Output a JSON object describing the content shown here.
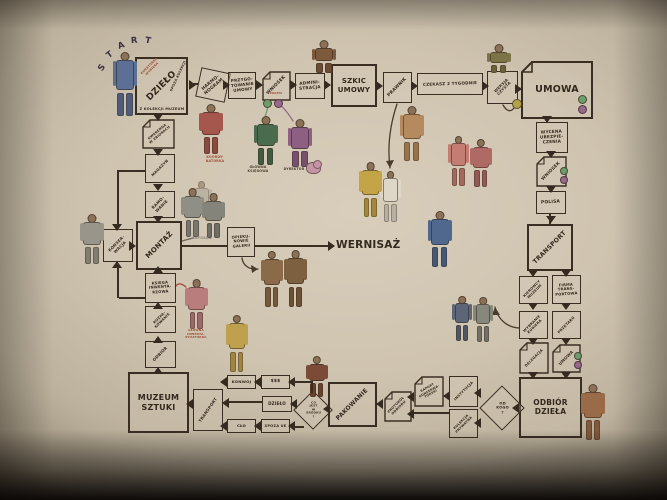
{
  "palette": {
    "wall": "#cfc4b0",
    "ink": "#3a2e22",
    "caption_red": "#9e4a38",
    "sig_green": "#6f9c6d",
    "sig_violet": "#96688c",
    "sig_yellow": "#b3a14b"
  },
  "diagram": {
    "start": {
      "text": "START"
    },
    "nodes": [
      {
        "id": "dzielo",
        "label": "DZIEŁO",
        "type": "box",
        "x": 135,
        "y": 57,
        "w": 53,
        "h": 58,
        "fs": 9,
        "rot": -45,
        "thick": true
      },
      {
        "id": "harmonogram",
        "label": "HARMO-\nNOGRAM",
        "type": "box",
        "x": 198,
        "y": 70,
        "w": 30,
        "h": 30,
        "fs": 4.4,
        "rot": -40,
        "tilt": 12
      },
      {
        "id": "przygotowanie-umowy",
        "label": "PRZYGO-\nTOWANIE\nUMOWY",
        "type": "box",
        "x": 228,
        "y": 72,
        "w": 28,
        "h": 27,
        "fs": 4.1,
        "rot": -6
      },
      {
        "id": "wniosek-1",
        "label": "WNIOSEK",
        "type": "doc",
        "x": 262,
        "y": 71,
        "w": 29,
        "h": 30,
        "fs": 4.4,
        "rot": -45
      },
      {
        "id": "administracja",
        "label": "ADMINI-\nSTRACJA",
        "type": "box",
        "x": 295,
        "y": 73,
        "w": 30,
        "h": 26,
        "fs": 4.2,
        "rot": -5
      },
      {
        "id": "szkic-umowy",
        "label": "SZKIC\nUMOWY",
        "type": "box",
        "x": 331,
        "y": 64,
        "w": 46,
        "h": 43,
        "fs": 7,
        "rot": 0,
        "thick": true
      },
      {
        "id": "prawnik",
        "label": "PRAWNIK",
        "type": "box",
        "x": 383,
        "y": 72,
        "w": 29,
        "h": 31,
        "fs": 4.4,
        "rot": -45
      },
      {
        "id": "czekasz-2-tygodnie",
        "label": "CZEKASZ 2 TYGODNIE",
        "type": "box",
        "x": 417,
        "y": 73,
        "w": 66,
        "h": 22,
        "fs": 4.1,
        "rot": -2
      },
      {
        "id": "wersja-czysta",
        "label": "WERSJA\nCZYSTA",
        "type": "box",
        "x": 487,
        "y": 71,
        "w": 31,
        "h": 33,
        "fs": 3.8,
        "rot": -45
      },
      {
        "id": "umowa",
        "label": "UMOWA",
        "type": "doc",
        "x": 521,
        "y": 61,
        "w": 72,
        "h": 58,
        "fs": 9.5,
        "rot": 0,
        "thick": true,
        "fold": 11
      },
      {
        "id": "wycena-ubezpieczenia",
        "label": "WYCENA\nUBEZPIE-\nCZENIA",
        "type": "box",
        "x": 536,
        "y": 122,
        "w": 32,
        "h": 31,
        "fs": 4.2,
        "rot": -3
      },
      {
        "id": "wniosek-2",
        "label": "WNIOSEK",
        "type": "doc",
        "x": 536,
        "y": 156,
        "w": 31,
        "h": 31,
        "fs": 4.3,
        "rot": -45
      },
      {
        "id": "polisa",
        "label": "POLISA",
        "type": "box",
        "x": 536,
        "y": 191,
        "w": 30,
        "h": 23,
        "fs": 4.4,
        "rot": -3
      },
      {
        "id": "transport-1",
        "label": "TRANSPORT",
        "type": "box",
        "x": 527,
        "y": 224,
        "w": 46,
        "h": 47,
        "fs": 6.2,
        "rot": -45,
        "thick": true
      },
      {
        "id": "kierowcy-muzeum",
        "label": "KIEROWCY\nMUZEUM",
        "type": "box",
        "x": 519,
        "y": 276,
        "w": 29,
        "h": 28,
        "fs": 3.5,
        "rot": -45
      },
      {
        "id": "firma-transportowa",
        "label": "FIRMA\nTRANS-\nPORTOWA",
        "type": "box",
        "x": 552,
        "y": 275,
        "w": 29,
        "h": 29,
        "fs": 3.7,
        "rot": -4
      },
      {
        "id": "wybranie-kuriera",
        "label": "WYBRANIE\nKURIERA",
        "type": "box",
        "x": 519,
        "y": 311,
        "w": 29,
        "h": 28,
        "fs": 3.5,
        "rot": -45
      },
      {
        "id": "przetarg",
        "label": "PRZETARG",
        "type": "box",
        "x": 552,
        "y": 311,
        "w": 29,
        "h": 28,
        "fs": 3.6,
        "rot": -45
      },
      {
        "id": "delegacja",
        "label": "DELEGACJA",
        "type": "doc",
        "x": 519,
        "y": 342,
        "w": 30,
        "h": 32,
        "fs": 3.5,
        "rot": -45
      },
      {
        "id": "umowa-2",
        "label": "UMOWA",
        "type": "doc",
        "x": 552,
        "y": 344,
        "w": 29,
        "h": 29,
        "fs": 4,
        "rot": -45
      },
      {
        "id": "odbior-dziela",
        "label": "ODBIÓR\nDZIEŁA",
        "type": "box",
        "x": 519,
        "y": 377,
        "w": 63,
        "h": 61,
        "fs": 7.5,
        "rot": 0,
        "thick": true
      },
      {
        "id": "od-kogo",
        "label": "OD\nKOGO\n?",
        "type": "diamond",
        "x": 486,
        "y": 392,
        "w": 32,
        "h": 32,
        "fs": 3.7,
        "rot": 0
      },
      {
        "id": "instytucja",
        "label": "INSTYTUCJA",
        "type": "box",
        "x": 449,
        "y": 376,
        "w": 29,
        "h": 31,
        "fs": 3.5,
        "rot": -45
      },
      {
        "id": "kolekcja-prywatna",
        "label": "KOLEKCJA\nPRYWATNA",
        "type": "box",
        "x": 449,
        "y": 409,
        "w": 29,
        "h": 29,
        "fs": 3.3,
        "rot": -45
      },
      {
        "id": "raport-konserwatorski",
        "label": "RAPORT\nKONSERWA-\nTORSKI",
        "type": "doc",
        "x": 414,
        "y": 376,
        "w": 30,
        "h": 31,
        "fs": 3.1,
        "rot": -30
      },
      {
        "id": "protokol-odbioru",
        "label": "PROTOKÓŁ\nODBIORU",
        "type": "doc",
        "x": 384,
        "y": 391,
        "w": 28,
        "h": 31,
        "fs": 3.3,
        "rot": -45
      },
      {
        "id": "pakowanie",
        "label": "PAKOWANIE",
        "type": "box",
        "x": 328,
        "y": 382,
        "w": 49,
        "h": 45,
        "fs": 6,
        "rot": -45,
        "thick": true
      },
      {
        "id": "co-jest-w-srodku",
        "label": "CO\nJEST\nW\nŚRODKU\n?",
        "type": "diamond",
        "x": 299,
        "y": 396,
        "w": 28,
        "h": 28,
        "fs": 2.9,
        "rot": 0
      },
      {
        "id": "konwoj",
        "label": "KONWÓJ",
        "type": "box",
        "x": 227,
        "y": 375,
        "w": 29,
        "h": 14,
        "fs": 3.9,
        "rot": 0
      },
      {
        "id": "dolary",
        "label": "$$$",
        "type": "box",
        "x": 261,
        "y": 375,
        "w": 29,
        "h": 14,
        "fs": 4.4,
        "rot": 0
      },
      {
        "id": "dzielo-2",
        "label": "DZIEŁO",
        "type": "box",
        "x": 262,
        "y": 396,
        "w": 30,
        "h": 16,
        "fs": 4.1,
        "rot": 0
      },
      {
        "id": "clo",
        "label": "CŁO",
        "type": "box",
        "x": 227,
        "y": 419,
        "w": 29,
        "h": 14,
        "fs": 3.9,
        "rot": 0
      },
      {
        "id": "spoza-ue",
        "label": "SPOZA UE",
        "type": "box",
        "x": 261,
        "y": 419,
        "w": 29,
        "h": 14,
        "fs": 3.6,
        "rot": 0
      },
      {
        "id": "transport-2",
        "label": "TRANSPORT",
        "type": "box",
        "x": 193,
        "y": 389,
        "w": 30,
        "h": 42,
        "fs": 4,
        "rot": -55
      },
      {
        "id": "muzeum-sztuki",
        "label": "MUZEUM\nSZTUKI",
        "type": "box",
        "x": 128,
        "y": 372,
        "w": 61,
        "h": 61,
        "fs": 8,
        "rot": 0,
        "thick": true
      },
      {
        "id": "odbior",
        "label": "ODBIÓR",
        "type": "box",
        "x": 145,
        "y": 341,
        "w": 31,
        "h": 27,
        "fs": 4,
        "rot": -45
      },
      {
        "id": "rozpakowanie",
        "label": "ROZPA-\nKOWANIE",
        "type": "box",
        "x": 145,
        "y": 306,
        "w": 31,
        "h": 27,
        "fs": 3.5,
        "rot": -45
      },
      {
        "id": "ksiega-inwentarzowa",
        "label": "KSIĘGA\nINWENTA-\nRZOWA",
        "type": "box",
        "x": 145,
        "y": 273,
        "w": 31,
        "h": 30,
        "fs": 3.7,
        "rot": -4
      },
      {
        "id": "montaz",
        "label": "MONTAŻ",
        "type": "box",
        "x": 136,
        "y": 221,
        "w": 46,
        "h": 49,
        "fs": 7,
        "rot": -45,
        "thick": true
      },
      {
        "id": "ramowanie",
        "label": "RAMO-\nWANIE",
        "type": "box",
        "x": 145,
        "y": 191,
        "w": 30,
        "h": 27,
        "fs": 4,
        "rot": -45
      },
      {
        "id": "magazyn",
        "label": "MAGAZYN",
        "type": "box",
        "x": 145,
        "y": 154,
        "w": 30,
        "h": 29,
        "fs": 3.7,
        "rot": -45
      },
      {
        "id": "kwerenda-w-zbiorach",
        "label": "KWERENDA\nW ZBIORACH",
        "type": "doc",
        "x": 142,
        "y": 119,
        "w": 33,
        "h": 30,
        "fs": 3.3,
        "rot": -40
      },
      {
        "id": "konserwacja",
        "label": "KONSER-\nWACJA",
        "type": "box",
        "x": 103,
        "y": 229,
        "w": 30,
        "h": 33,
        "fs": 3.9,
        "rot": -45
      },
      {
        "id": "opiekunowie-galerii",
        "label": "OPIEKU-\nNOWIE\nGALERII",
        "type": "box",
        "x": 227,
        "y": 227,
        "w": 28,
        "h": 30,
        "fs": 3.7,
        "rot": -4
      }
    ],
    "captions": [
      {
        "id": "wernisaz",
        "text": "WERNISAŻ",
        "x": 336,
        "y": 239,
        "w": 62,
        "fs": 10.5,
        "color": "#352a1f"
      },
      {
        "id": "kuratorka-wybiera",
        "text": "KURATORKA\nWYBIERA",
        "x": 138,
        "y": 64,
        "w": 26,
        "fs": 3,
        "color": "#9e4a38",
        "rot": -45
      },
      {
        "id": "spoza-kolekcji",
        "text": "SPOZA KOLEKCJI",
        "x": 160,
        "y": 74,
        "w": 36,
        "fs": 3.3,
        "color": "#3a2e22",
        "rot": -65
      },
      {
        "id": "z-kolekcji-muzeum",
        "text": "Z KOLEKCJI MUZEUM",
        "x": 135,
        "y": 107,
        "w": 54,
        "fs": 3.6,
        "color": "#3a2e22"
      },
      {
        "id": "podpis",
        "text": "PODPIS",
        "x": 266,
        "y": 92,
        "w": 20,
        "fs": 2.7,
        "color": "#9e4a38"
      },
      {
        "id": "koordynatorka",
        "text": "KOORDY-\nNATORKA",
        "x": 201,
        "y": 155,
        "w": 28,
        "fs": 3.2,
        "color": "#9e4a38"
      },
      {
        "id": "glowna-ksiegowa",
        "text": "GŁÓWNA\nKSIĘGOWA",
        "x": 243,
        "y": 165,
        "w": 30,
        "fs": 3.2,
        "color": "#4a3a2c"
      },
      {
        "id": "dyrektor",
        "text": "DYREKTOR",
        "x": 279,
        "y": 167,
        "w": 30,
        "fs": 3.2,
        "color": "#4a3a2c"
      },
      {
        "id": "brygada",
        "text": "BRYGADA",
        "x": 188,
        "y": 236,
        "w": 28,
        "fs": 3.3,
        "color": "#8d887c"
      },
      {
        "id": "glowna-inwentaryzatorka",
        "text": "GŁÓWNA\nINWENTA-\nRYZATORKA",
        "x": 181,
        "y": 329,
        "w": 30,
        "fs": 2.9,
        "color": "#9e4a38"
      }
    ],
    "figures": [
      {
        "name": "kuratorka-start",
        "x": 112,
        "y": 52,
        "w": 26,
        "h": 64,
        "c": "#5c6f94"
      },
      {
        "name": "koordynatorka",
        "x": 199,
        "y": 104,
        "w": 24,
        "h": 50,
        "c": "#a5574d"
      },
      {
        "name": "glowna-ksiegowa",
        "x": 253,
        "y": 116,
        "w": 25,
        "h": 49,
        "c": "#4b6b4e"
      },
      {
        "name": "dyrektor",
        "x": 287,
        "y": 119,
        "w": 26,
        "h": 48,
        "c": "#8d5f83"
      },
      {
        "name": "administracja-sitter",
        "x": 311,
        "y": 40,
        "w": 26,
        "h": 33,
        "c": "#7d5a3c"
      },
      {
        "name": "wersja-czysta-climber",
        "x": 486,
        "y": 44,
        "w": 25,
        "h": 29,
        "c": "#7c7446"
      },
      {
        "name": "prawnik-walker",
        "x": 399,
        "y": 106,
        "w": 25,
        "h": 55,
        "c": "#b58a5e"
      },
      {
        "name": "white-figure",
        "x": 380,
        "y": 171,
        "w": 21,
        "h": 51,
        "c": "#ded7c8"
      },
      {
        "name": "pink-pair-a",
        "x": 448,
        "y": 136,
        "w": 21,
        "h": 50,
        "c": "#c47d72"
      },
      {
        "name": "pink-pair-b",
        "x": 470,
        "y": 139,
        "w": 22,
        "h": 48,
        "c": "#b06a66"
      },
      {
        "name": "yellow-visitor",
        "x": 359,
        "y": 162,
        "w": 23,
        "h": 55,
        "c": "#c3a446"
      },
      {
        "name": "blue-walker",
        "x": 427,
        "y": 211,
        "w": 25,
        "h": 56,
        "c": "#50688e"
      },
      {
        "name": "brygada-ghost",
        "x": 191,
        "y": 181,
        "w": 21,
        "h": 36,
        "c": "#a8a396",
        "o": 0.55
      },
      {
        "name": "brygada-a",
        "x": 181,
        "y": 188,
        "w": 23,
        "h": 49,
        "c": "#8f8f85"
      },
      {
        "name": "brygada-b",
        "x": 202,
        "y": 193,
        "w": 23,
        "h": 45,
        "c": "#84847a"
      },
      {
        "name": "konserwatorka",
        "x": 80,
        "y": 214,
        "w": 24,
        "h": 50,
        "c": "#9a958a"
      },
      {
        "name": "inwentaryzatorka",
        "x": 185,
        "y": 279,
        "w": 23,
        "h": 50,
        "c": "#b97d7d"
      },
      {
        "name": "opiekun-a",
        "x": 261,
        "y": 251,
        "w": 22,
        "h": 56,
        "c": "#8a6a48"
      },
      {
        "name": "opiekun-b",
        "x": 284,
        "y": 250,
        "w": 23,
        "h": 57,
        "c": "#7d603f"
      },
      {
        "name": "konwoj-stander",
        "x": 226,
        "y": 315,
        "w": 22,
        "h": 57,
        "c": "#bfa04e"
      },
      {
        "name": "diamond-stander",
        "x": 306,
        "y": 356,
        "w": 22,
        "h": 41,
        "c": "#7c4b38"
      },
      {
        "name": "kurier-a",
        "x": 452,
        "y": 296,
        "w": 20,
        "h": 45,
        "c": "#5d6678"
      },
      {
        "name": "kurier-b",
        "x": 473,
        "y": 297,
        "w": 20,
        "h": 45,
        "c": "#87887c"
      },
      {
        "name": "odbior-helper",
        "x": 581,
        "y": 384,
        "w": 24,
        "h": 56,
        "c": "#9a6b48"
      },
      {
        "name": "teddy-bear",
        "x": 306,
        "y": 160,
        "w": 16,
        "h": 14,
        "c": "#c495a5",
        "teddy": true
      }
    ],
    "dots": [
      {
        "x": 263,
        "y": 99,
        "r": 9,
        "c": "green"
      },
      {
        "x": 274,
        "y": 99,
        "r": 9,
        "c": "violet"
      },
      {
        "x": 578,
        "y": 95,
        "r": 9,
        "c": "green"
      },
      {
        "x": 578,
        "y": 105,
        "r": 9,
        "c": "violet"
      },
      {
        "x": 560,
        "y": 167,
        "r": 8,
        "c": "green"
      },
      {
        "x": 560,
        "y": 176,
        "r": 8,
        "c": "violet"
      },
      {
        "x": 574,
        "y": 352,
        "r": 8,
        "c": "green"
      },
      {
        "x": 574,
        "y": 361,
        "r": 8,
        "c": "violet"
      },
      {
        "x": 512,
        "y": 99,
        "r": 10,
        "c": "yellow"
      }
    ],
    "heads": [
      [
        189,
        80,
        "r"
      ],
      [
        223,
        80,
        "r"
      ],
      [
        256,
        80,
        "r"
      ],
      [
        290,
        80,
        "r"
      ],
      [
        324,
        80,
        "r"
      ],
      [
        376,
        81,
        "r"
      ],
      [
        411,
        81,
        "r"
      ],
      [
        482,
        81,
        "r"
      ],
      [
        515,
        84,
        "r"
      ],
      [
        542,
        116,
        "d"
      ],
      [
        546,
        151,
        "d"
      ],
      [
        546,
        186,
        "d"
      ],
      [
        546,
        216,
        "d"
      ],
      [
        528,
        270,
        "d"
      ],
      [
        561,
        270,
        "d"
      ],
      [
        528,
        303,
        "d"
      ],
      [
        561,
        303,
        "d"
      ],
      [
        528,
        338,
        "d"
      ],
      [
        561,
        338,
        "d"
      ],
      [
        528,
        372,
        "d"
      ],
      [
        561,
        372,
        "d"
      ],
      [
        153,
        114,
        "d"
      ],
      [
        153,
        149,
        "d"
      ],
      [
        153,
        184,
        "d"
      ],
      [
        153,
        216,
        "d"
      ],
      [
        153,
        266,
        "u"
      ],
      [
        153,
        302,
        "u"
      ],
      [
        153,
        336,
        "u"
      ],
      [
        153,
        367,
        "u"
      ],
      [
        112,
        224,
        "d"
      ],
      [
        112,
        261,
        "u"
      ],
      [
        129,
        241,
        "r"
      ],
      [
        328,
        241,
        "r"
      ],
      [
        512,
        403,
        "l"
      ],
      [
        474,
        388,
        "l"
      ],
      [
        474,
        418,
        "l"
      ],
      [
        443,
        391,
        "l"
      ],
      [
        407,
        392,
        "l"
      ],
      [
        407,
        409,
        "l"
      ],
      [
        376,
        399,
        "l"
      ],
      [
        323,
        404,
        "l"
      ],
      [
        288,
        377,
        "l"
      ],
      [
        254,
        377,
        "l"
      ],
      [
        220,
        377,
        "l"
      ],
      [
        290,
        399,
        "l"
      ],
      [
        222,
        398,
        "l"
      ],
      [
        288,
        421,
        "l"
      ],
      [
        254,
        421,
        "l"
      ],
      [
        220,
        421,
        "l"
      ],
      [
        186,
        399,
        "l"
      ]
    ],
    "lines": [
      [
        549,
        214,
        1.6,
        10
      ],
      [
        117,
        170,
        1.6,
        56
      ],
      [
        119,
        170,
        26,
        1.6
      ],
      [
        117,
        264,
        1.6,
        34
      ],
      [
        119,
        297,
        26,
        1.6
      ],
      [
        182,
        245,
        45,
        1.6
      ],
      [
        255,
        245,
        73,
        1.6
      ],
      [
        414,
        412,
        36,
        1.6
      ],
      [
        229,
        401,
        33,
        1.6
      ],
      [
        291,
        381,
        21,
        1.6
      ],
      [
        311,
        381,
        1.6,
        12
      ],
      [
        292,
        426,
        12,
        1.6
      ],
      [
        190,
        83,
        8,
        1.6
      ]
    ]
  }
}
